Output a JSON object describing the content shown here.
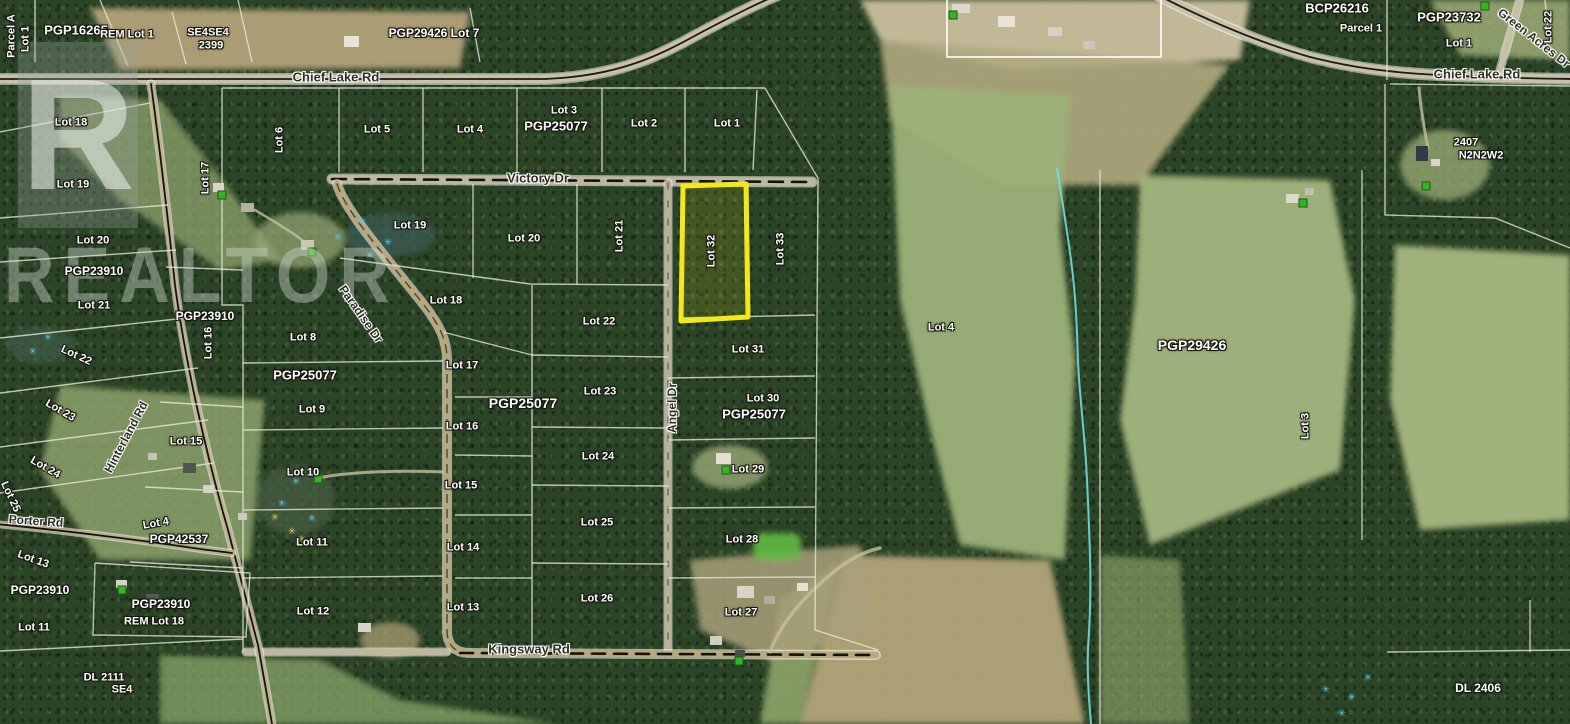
{
  "watermark": {
    "logo_letter": "R",
    "text": "REALTOR"
  },
  "highlight": {
    "label": "Lot 32",
    "color": "#f4e81c"
  },
  "icons": {
    "marsh_glyph": "✳",
    "pin_name": "property-pin-icon",
    "marsh_name": "marsh-icon"
  },
  "map": {
    "road_names": [
      "Chief Lake Rd",
      "Victory Dr",
      "Paradise Dr",
      "Angel Dr",
      "Hinterland Rd",
      "Porter Rd",
      "Kingsway Rd",
      "Green Acres Dr"
    ],
    "labels": [
      {
        "t": "Parcel A",
        "x": 12,
        "y": 36,
        "r": -90
      },
      {
        "t": "Lot 1",
        "x": 26,
        "y": 39,
        "r": -90
      },
      {
        "t": "PGP16265",
        "x": 76,
        "y": 30,
        "s": 13
      },
      {
        "t": "REM Lot 1",
        "x": 127,
        "y": 35
      },
      {
        "t": "SE4SE4",
        "x": 208,
        "y": 33
      },
      {
        "t": "2399",
        "x": 211,
        "y": 46
      },
      {
        "t": "PGP29426 Lot 7",
        "x": 434,
        "y": 33,
        "s": 12
      },
      {
        "t": "Chief Lake Rd",
        "x": 336,
        "y": 77,
        "s": 13,
        "road": true
      },
      {
        "t": "BCP26216",
        "x": 1337,
        "y": 8,
        "s": 13
      },
      {
        "t": "Parcel 1",
        "x": 1361,
        "y": 29
      },
      {
        "t": "PGP23732",
        "x": 1449,
        "y": 17,
        "s": 13
      },
      {
        "t": "Lot 1",
        "x": 1459,
        "y": 44
      },
      {
        "t": "Green Acres Dr",
        "x": 1534,
        "y": 38,
        "r": 38,
        "s": 12,
        "road": true
      },
      {
        "t": "Lot 22",
        "x": 1549,
        "y": 27,
        "r": -90
      },
      {
        "t": "Chief Lake Rd",
        "x": 1477,
        "y": 74,
        "s": 13,
        "road": true
      },
      {
        "t": "2407",
        "x": 1466,
        "y": 143
      },
      {
        "t": "N2N2W2",
        "x": 1481,
        "y": 156
      },
      {
        "t": "Lot 6",
        "x": 280,
        "y": 140,
        "r": -90
      },
      {
        "t": "Lot 5",
        "x": 377,
        "y": 130
      },
      {
        "t": "Lot 4",
        "x": 470,
        "y": 130
      },
      {
        "t": "Lot 3",
        "x": 564,
        "y": 111
      },
      {
        "t": "PGP25077",
        "x": 556,
        "y": 126,
        "s": 13
      },
      {
        "t": "Lot 2",
        "x": 644,
        "y": 124
      },
      {
        "t": "Lot 1",
        "x": 727,
        "y": 124
      },
      {
        "t": "Victory Dr",
        "x": 538,
        "y": 178,
        "s": 13,
        "road": true
      },
      {
        "t": "Lot 19",
        "x": 410,
        "y": 226
      },
      {
        "t": "Lot 20",
        "x": 524,
        "y": 239
      },
      {
        "t": "Lot 21",
        "x": 620,
        "y": 236,
        "r": -90
      },
      {
        "t": "Lot 32",
        "x": 712,
        "y": 251,
        "r": -90
      },
      {
        "t": "Lot 33",
        "x": 781,
        "y": 249,
        "r": -90
      },
      {
        "t": "Paradise Dr",
        "x": 361,
        "y": 314,
        "r": 55,
        "s": 12,
        "road": true
      },
      {
        "t": "Lot 18",
        "x": 446,
        "y": 301
      },
      {
        "t": "Lot 22",
        "x": 599,
        "y": 322
      },
      {
        "t": "Lot 8",
        "x": 303,
        "y": 338
      },
      {
        "t": "PGP25077",
        "x": 305,
        "y": 375,
        "s": 13
      },
      {
        "t": "Lot 9",
        "x": 312,
        "y": 410
      },
      {
        "t": "Lot 10",
        "x": 303,
        "y": 473
      },
      {
        "t": "Lot 11",
        "x": 312,
        "y": 543
      },
      {
        "t": "Lot 12",
        "x": 313,
        "y": 612
      },
      {
        "t": "Lot 17",
        "x": 462,
        "y": 366
      },
      {
        "t": "PGP25077",
        "x": 523,
        "y": 403,
        "s": 14
      },
      {
        "t": "Lot 16",
        "x": 462,
        "y": 427
      },
      {
        "t": "Lot 15",
        "x": 461,
        "y": 486
      },
      {
        "t": "Lot 14",
        "x": 463,
        "y": 548
      },
      {
        "t": "Lot 13",
        "x": 463,
        "y": 608
      },
      {
        "t": "Lot 23",
        "x": 600,
        "y": 392
      },
      {
        "t": "Lot 24",
        "x": 598,
        "y": 457
      },
      {
        "t": "Lot 25",
        "x": 597,
        "y": 523
      },
      {
        "t": "Lot 26",
        "x": 597,
        "y": 599
      },
      {
        "t": "Angel Dr",
        "x": 672,
        "y": 408,
        "r": -90,
        "s": 12,
        "road": true
      },
      {
        "t": "Kingsway Rd",
        "x": 529,
        "y": 649,
        "s": 13,
        "road": true
      },
      {
        "t": "Lot 31",
        "x": 748,
        "y": 350
      },
      {
        "t": "Lot 30",
        "x": 763,
        "y": 399
      },
      {
        "t": "PGP25077",
        "x": 754,
        "y": 414,
        "s": 13
      },
      {
        "t": "Lot 29",
        "x": 748,
        "y": 470
      },
      {
        "t": "Lot 28",
        "x": 742,
        "y": 540
      },
      {
        "t": "Lot 27",
        "x": 741,
        "y": 613
      },
      {
        "t": "Lot 18",
        "x": 71,
        "y": 123
      },
      {
        "t": "Lot 19",
        "x": 73,
        "y": 185
      },
      {
        "t": "Lot 17",
        "x": 206,
        "y": 178,
        "r": -90
      },
      {
        "t": "Lot 20",
        "x": 93,
        "y": 241
      },
      {
        "t": "PGP23910",
        "x": 94,
        "y": 271,
        "s": 12
      },
      {
        "t": "Lot 21",
        "x": 94,
        "y": 306
      },
      {
        "t": "Lot 22",
        "x": 76,
        "y": 356,
        "r": 25
      },
      {
        "t": "PGP23910",
        "x": 205,
        "y": 316,
        "s": 12
      },
      {
        "t": "Lot 16",
        "x": 209,
        "y": 343,
        "r": -90
      },
      {
        "t": "Hinterland Rd",
        "x": 126,
        "y": 437,
        "r": -62,
        "s": 12,
        "road": true
      },
      {
        "t": "Lot 23",
        "x": 60,
        "y": 411,
        "r": 30
      },
      {
        "t": "Lot 24",
        "x": 45,
        "y": 468,
        "r": 30
      },
      {
        "t": "Lot 25",
        "x": 10,
        "y": 497,
        "r": 65
      },
      {
        "t": "Lot 15",
        "x": 186,
        "y": 442
      },
      {
        "t": "Porter Rd",
        "x": 36,
        "y": 521,
        "r": 4,
        "s": 12,
        "road": true
      },
      {
        "t": "Lot 4",
        "x": 156,
        "y": 524,
        "r": -10
      },
      {
        "t": "PGP42537",
        "x": 179,
        "y": 539,
        "s": 12
      },
      {
        "t": "Lot 13",
        "x": 33,
        "y": 560,
        "r": 20
      },
      {
        "t": "PGP23910",
        "x": 40,
        "y": 590,
        "s": 12
      },
      {
        "t": "Lot 11",
        "x": 34,
        "y": 628
      },
      {
        "t": "PGP23910",
        "x": 161,
        "y": 604,
        "s": 12
      },
      {
        "t": "REM Lot 18",
        "x": 154,
        "y": 622
      },
      {
        "t": "DL 2111",
        "x": 104,
        "y": 678
      },
      {
        "t": "SE4",
        "x": 122,
        "y": 690
      },
      {
        "t": "Lot 4",
        "x": 941,
        "y": 328
      },
      {
        "t": "PGP29426",
        "x": 1192,
        "y": 345,
        "s": 14
      },
      {
        "t": "Lot 3",
        "x": 1306,
        "y": 426,
        "r": -90
      },
      {
        "t": "DL 2406",
        "x": 1478,
        "y": 688,
        "s": 12
      }
    ],
    "marsh_icons": [
      {
        "x": 362,
        "y": 222,
        "c": "#62c4e6"
      },
      {
        "x": 388,
        "y": 243,
        "c": "#62c4e6"
      },
      {
        "x": 416,
        "y": 228,
        "c": "#62c4e6"
      },
      {
        "x": 370,
        "y": 256,
        "c": "#62c4e6"
      },
      {
        "x": 338,
        "y": 238,
        "c": "#62c4e6"
      },
      {
        "x": 296,
        "y": 482,
        "c": "#62c4e6"
      },
      {
        "x": 282,
        "y": 504,
        "c": "#62c4e6"
      },
      {
        "x": 312,
        "y": 519,
        "c": "#62c4e6"
      },
      {
        "x": 48,
        "y": 338,
        "c": "#62c4e6"
      },
      {
        "x": 33,
        "y": 352,
        "c": "#62c4e6"
      },
      {
        "x": 62,
        "y": 352,
        "c": "#62c4e6"
      },
      {
        "x": 1352,
        "y": 698,
        "c": "#62c4e6"
      },
      {
        "x": 1368,
        "y": 678,
        "c": "#62c4e6"
      },
      {
        "x": 1342,
        "y": 714,
        "c": "#62c4e6"
      },
      {
        "x": 1326,
        "y": 690,
        "c": "#62c4e6"
      },
      {
        "x": 292,
        "y": 532,
        "c": "#d8c84a"
      },
      {
        "x": 275,
        "y": 518,
        "c": "#d8c84a"
      },
      {
        "x": 302,
        "y": 540,
        "c": "#d8c84a"
      }
    ],
    "pin_icons": [
      {
        "x": 222,
        "y": 195
      },
      {
        "x": 312,
        "y": 252
      },
      {
        "x": 318,
        "y": 479
      },
      {
        "x": 122,
        "y": 590
      },
      {
        "x": 726,
        "y": 470
      },
      {
        "x": 739,
        "y": 661
      },
      {
        "x": 1303,
        "y": 203
      },
      {
        "x": 1426,
        "y": 186
      },
      {
        "x": 1485,
        "y": 6
      },
      {
        "x": 953,
        "y": 15
      }
    ]
  }
}
